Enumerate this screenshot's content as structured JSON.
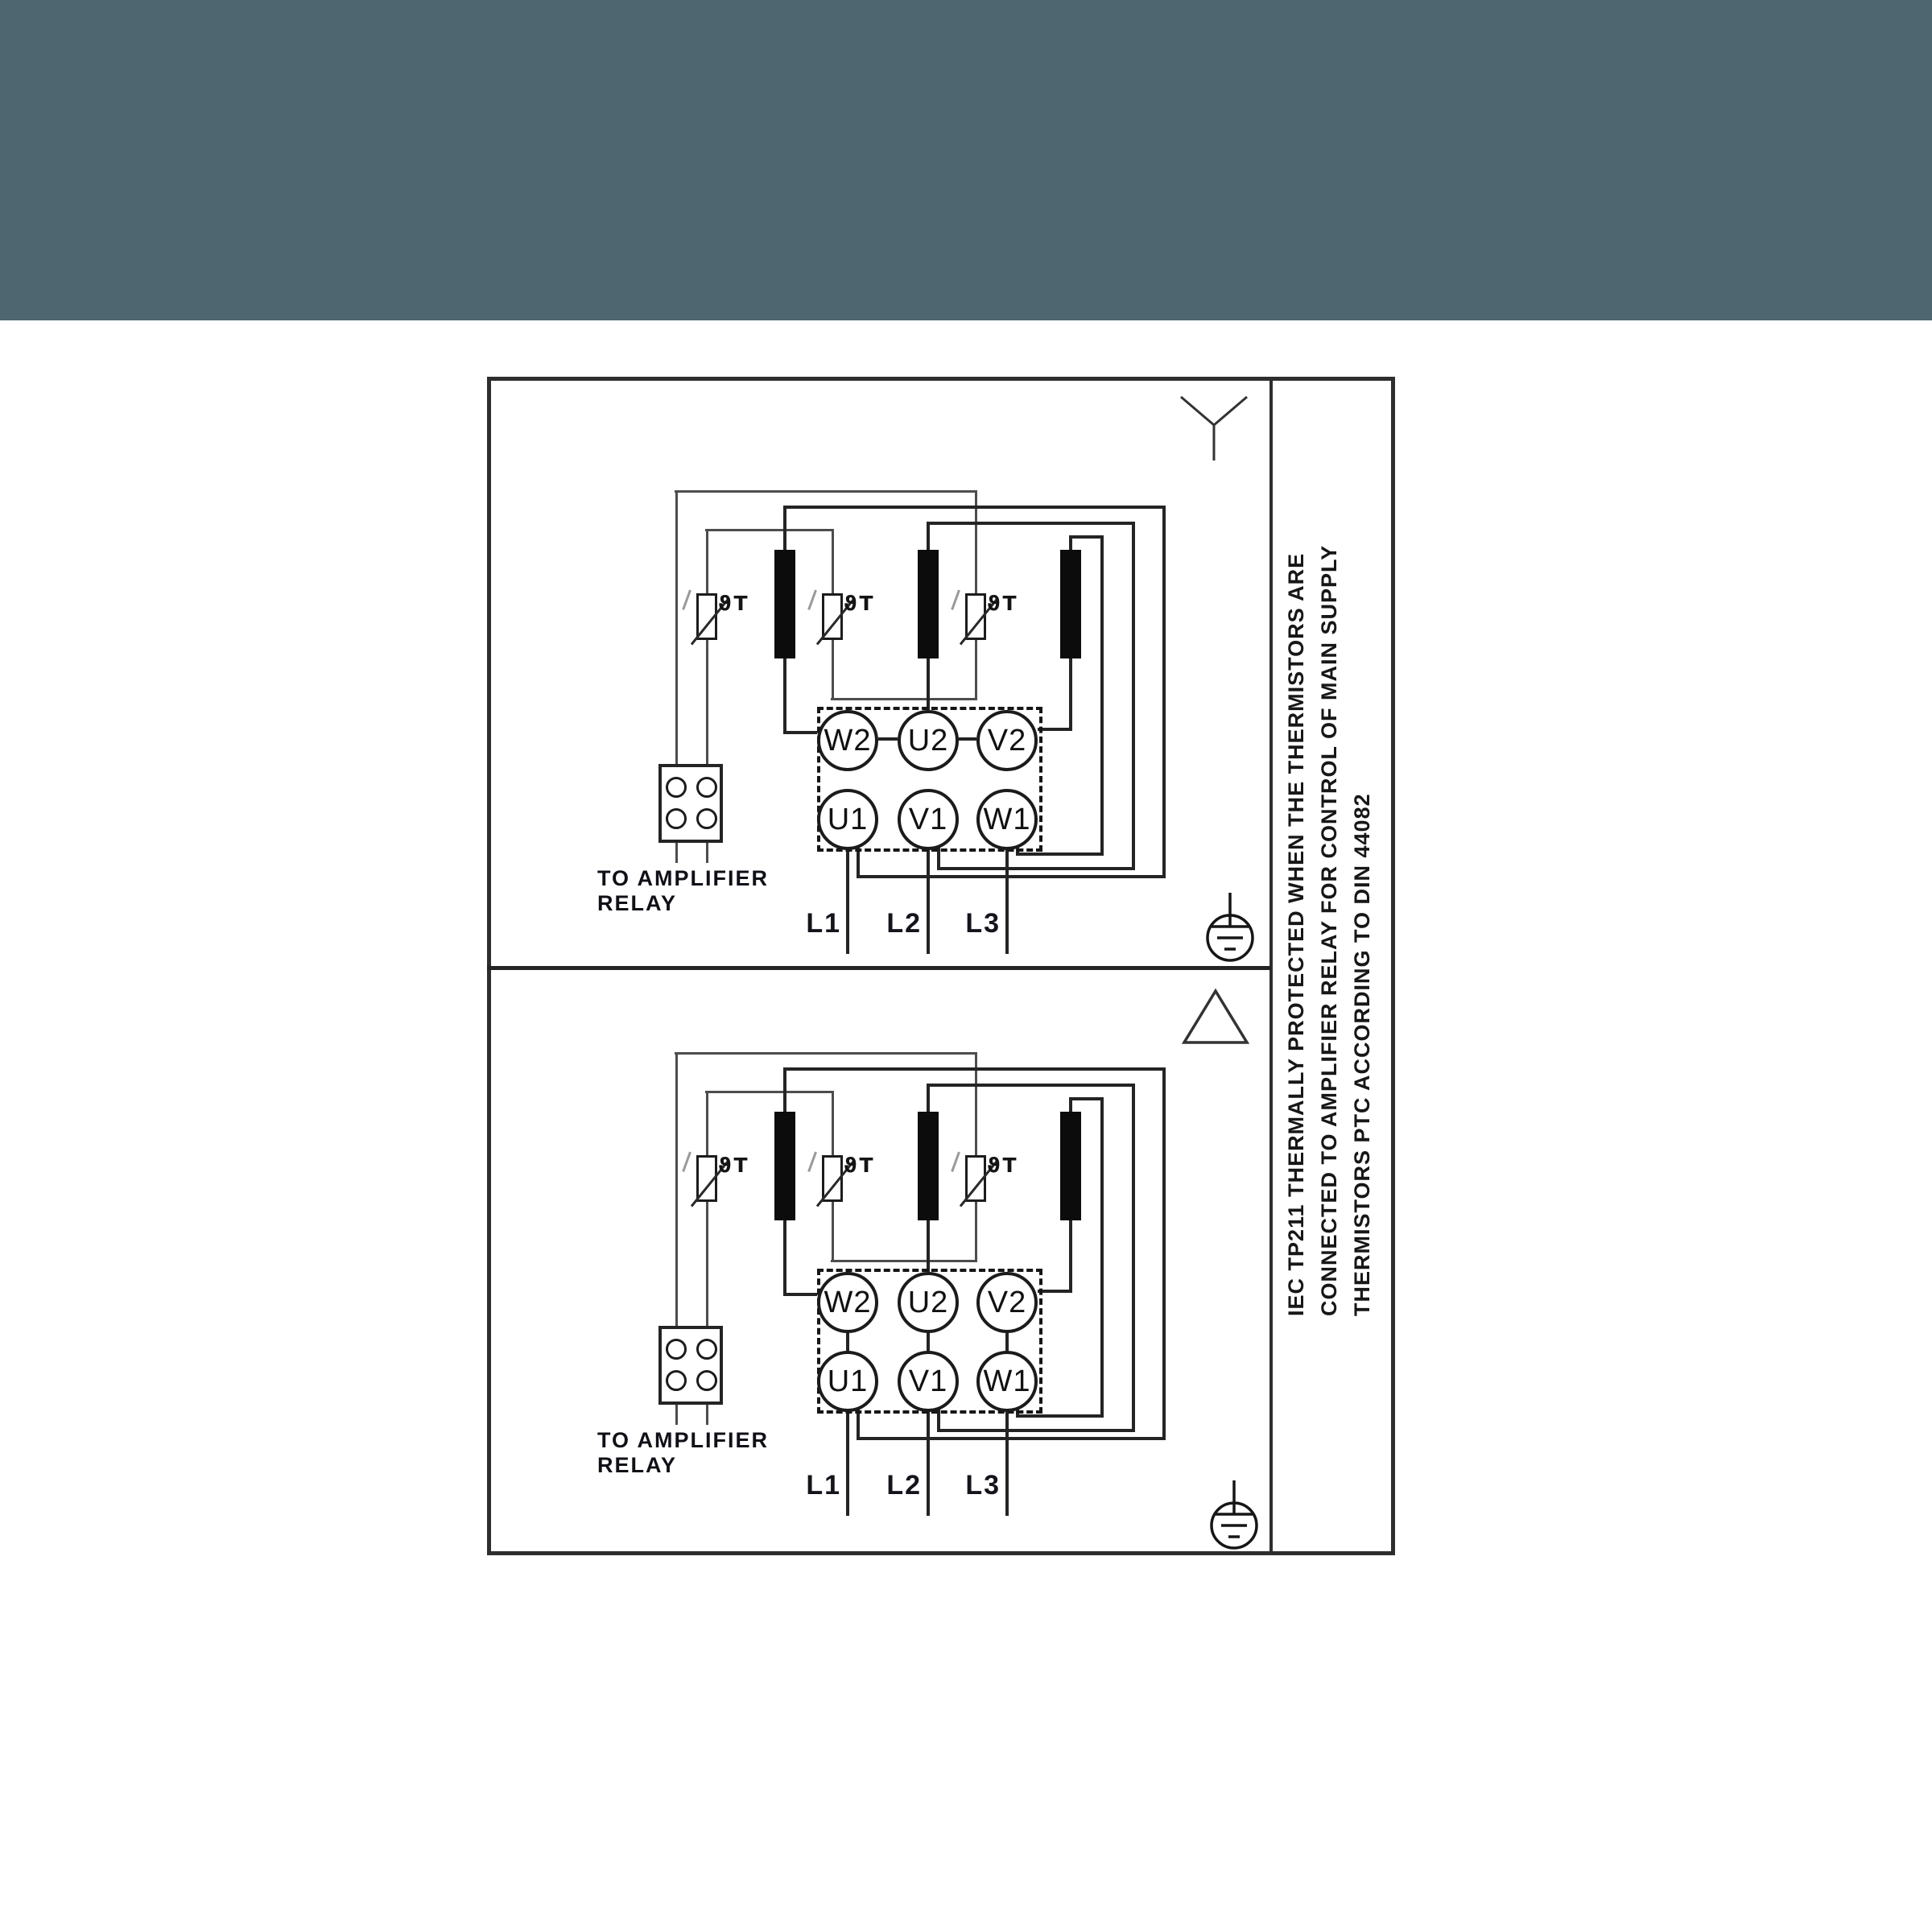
{
  "title": "Motor wiring diagram - star and delta connection",
  "colors": {
    "banner": "#4d6670",
    "line": "#242424",
    "thin_line": "#4d4d4d",
    "background": "#ffffff"
  },
  "star_section": {
    "connection_symbol": "star",
    "terminals": [
      "W2",
      "U2",
      "V2",
      "U1",
      "V1",
      "W1"
    ],
    "supply_labels": [
      "L1",
      "L2",
      "L3"
    ],
    "thermistor_mark": "ϑT",
    "relay_note": [
      "TO AMPLIFIER",
      "RELAY"
    ]
  },
  "delta_section": {
    "connection_symbol": "delta",
    "terminals": [
      "W2",
      "U2",
      "V2",
      "U1",
      "V1",
      "W1"
    ],
    "supply_labels": [
      "L1",
      "L2",
      "L3"
    ],
    "thermistor_mark": "ϑT",
    "relay_note": [
      "TO AMPLIFIER",
      "RELAY"
    ]
  },
  "side_note": {
    "line1": "IEC TP211 THERMALLY PROTECTED WHEN THE THERMISTORS ARE",
    "line2": "CONNECTED TO AMPLIFIER RELAY FOR CONTROL OF MAIN SUPPLY",
    "line3": "THERMISTORS PTC ACCORDING TO DIN 44082"
  }
}
